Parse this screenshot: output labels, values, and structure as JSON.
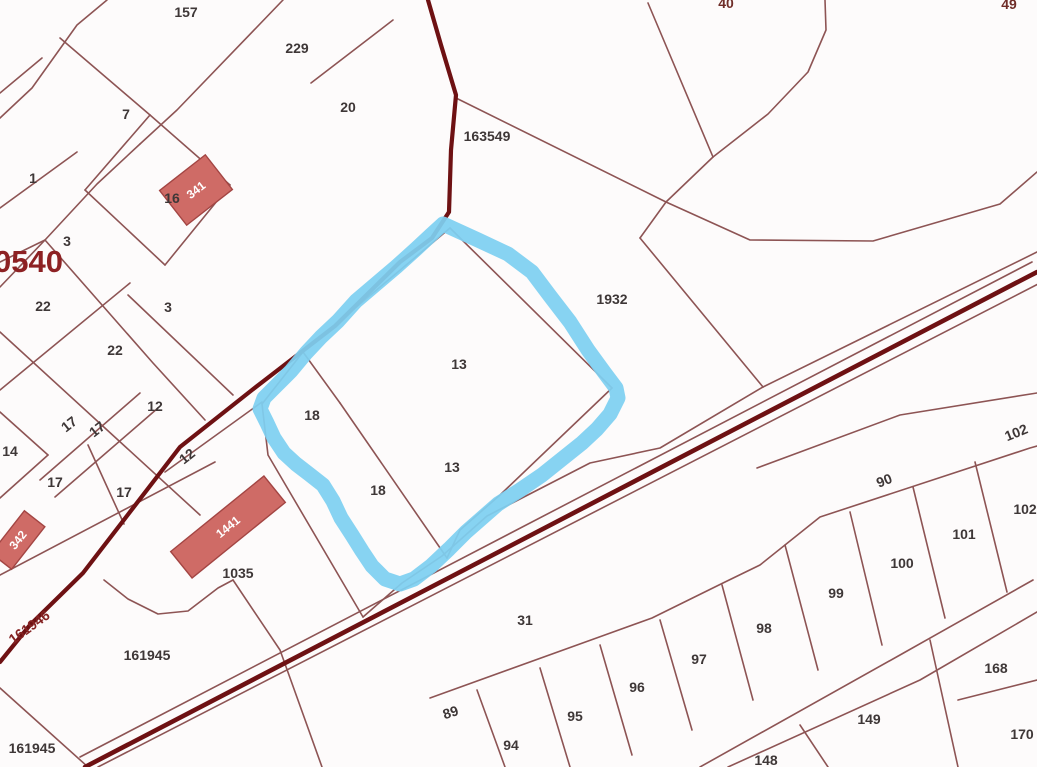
{
  "map": {
    "type": "cadastral-parcel-map",
    "background": "#fdfbfb",
    "colors": {
      "parcel_line": "#8d5454",
      "road_line": "#6e1113",
      "highlight_blue": "#7ed0f1",
      "building_fill": "#cf6b66",
      "building_stroke": "#a34543",
      "label_color": "#3e3737",
      "quarter_label_color": "#8d2123",
      "road_label_color": "#842222",
      "building_label_color": "#ffffff"
    },
    "quarter_label": {
      "text": "0540",
      "x": -6,
      "y": 272,
      "size": 31
    },
    "parcel_labels": [
      {
        "text": "157",
        "x": 186,
        "y": 17
      },
      {
        "text": "229",
        "x": 297,
        "y": 53
      },
      {
        "text": "7",
        "x": 126,
        "y": 119
      },
      {
        "text": "20",
        "x": 348,
        "y": 112
      },
      {
        "text": "163549",
        "x": 487,
        "y": 141
      },
      {
        "text": "1",
        "x": 33,
        "y": 183
      },
      {
        "text": "16",
        "x": 172,
        "y": 203
      },
      {
        "text": "3",
        "x": 67,
        "y": 246
      },
      {
        "text": "22",
        "x": 43,
        "y": 311
      },
      {
        "text": "3",
        "x": 168,
        "y": 312
      },
      {
        "text": "22",
        "x": 115,
        "y": 355
      },
      {
        "text": "12",
        "x": 155,
        "y": 411
      },
      {
        "text": "17",
        "x": 72,
        "y": 428,
        "rot": -38
      },
      {
        "text": "17",
        "x": 100,
        "y": 433,
        "rot": -38
      },
      {
        "text": "14",
        "x": 10,
        "y": 456
      },
      {
        "text": "17",
        "x": 55,
        "y": 487
      },
      {
        "text": "17",
        "x": 124,
        "y": 497
      },
      {
        "text": "12",
        "x": 190,
        "y": 460,
        "rot": -38
      },
      {
        "text": "1932",
        "x": 612,
        "y": 304
      },
      {
        "text": "13",
        "x": 459,
        "y": 369
      },
      {
        "text": "18",
        "x": 312,
        "y": 420
      },
      {
        "text": "13",
        "x": 452,
        "y": 472
      },
      {
        "text": "18",
        "x": 378,
        "y": 495
      },
      {
        "text": "1035",
        "x": 238,
        "y": 578
      },
      {
        "text": "161946",
        "x": 32,
        "y": 631,
        "rot": -36,
        "color": "#842222"
      },
      {
        "text": "161945",
        "x": 147,
        "y": 660
      },
      {
        "text": "161945",
        "x": 32,
        "y": 753
      },
      {
        "text": "31",
        "x": 525,
        "y": 625
      },
      {
        "text": "89",
        "x": 452,
        "y": 717,
        "rot": -18
      },
      {
        "text": "94",
        "x": 511,
        "y": 750
      },
      {
        "text": "95",
        "x": 575,
        "y": 721
      },
      {
        "text": "96",
        "x": 637,
        "y": 692
      },
      {
        "text": "97",
        "x": 699,
        "y": 664
      },
      {
        "text": "98",
        "x": 764,
        "y": 633
      },
      {
        "text": "99",
        "x": 836,
        "y": 598
      },
      {
        "text": "100",
        "x": 902,
        "y": 568
      },
      {
        "text": "101",
        "x": 964,
        "y": 539
      },
      {
        "text": "102",
        "x": 1025,
        "y": 514
      },
      {
        "text": "90",
        "x": 886,
        "y": 485,
        "rot": -22
      },
      {
        "text": "102",
        "x": 1018,
        "y": 437,
        "rot": -22
      },
      {
        "text": "148",
        "x": 766,
        "y": 765
      },
      {
        "text": "149",
        "x": 869,
        "y": 724
      },
      {
        "text": "168",
        "x": 996,
        "y": 673
      },
      {
        "text": "170",
        "x": 1022,
        "y": 739
      },
      {
        "text": "40",
        "x": 726,
        "y": 8,
        "color": "#6f2d28"
      },
      {
        "text": "49",
        "x": 1009,
        "y": 9,
        "color": "#6f2d28"
      }
    ],
    "buildings": [
      {
        "label": "341",
        "cx": 196,
        "cy": 190,
        "w": 58,
        "h": 44,
        "rot": -38
      },
      {
        "label": "1441",
        "cx": 228,
        "cy": 527,
        "w": 120,
        "h": 34,
        "rot": -39
      },
      {
        "label": "342",
        "cx": 18,
        "cy": 540,
        "w": 54,
        "h": 26,
        "rot": -52
      }
    ],
    "roads": [
      {
        "name": "road-north-south",
        "width": 4.2,
        "points": [
          [
            428,
            0
          ],
          [
            441,
            45
          ],
          [
            456,
            95
          ],
          [
            451,
            150
          ],
          [
            449,
            212
          ],
          [
            432,
            238
          ],
          [
            400,
            262
          ],
          [
            335,
            326
          ],
          [
            252,
            390
          ],
          [
            180,
            447
          ],
          [
            83,
            573
          ],
          [
            30,
            625
          ],
          [
            0,
            662
          ]
        ]
      },
      {
        "name": "road-diagonal",
        "width": 4.6,
        "points": [
          [
            85,
            767
          ],
          [
            1037,
            272
          ]
        ]
      }
    ],
    "highlight": {
      "name": "selected-parcel-outline",
      "color": "#7ed0f1",
      "width": 15,
      "opacity": 0.93,
      "points": [
        [
          443,
          224
        ],
        [
          478,
          240
        ],
        [
          508,
          254
        ],
        [
          532,
          272
        ],
        [
          550,
          296
        ],
        [
          570,
          322
        ],
        [
          588,
          350
        ],
        [
          604,
          372
        ],
        [
          616,
          388
        ],
        [
          618,
          398
        ],
        [
          610,
          414
        ],
        [
          597,
          429
        ],
        [
          582,
          443
        ],
        [
          562,
          459
        ],
        [
          542,
          475
        ],
        [
          520,
          490
        ],
        [
          498,
          504
        ],
        [
          482,
          518
        ],
        [
          466,
          532
        ],
        [
          449,
          549
        ],
        [
          431,
          566
        ],
        [
          414,
          579
        ],
        [
          400,
          584
        ],
        [
          385,
          579
        ],
        [
          372,
          566
        ],
        [
          362,
          551
        ],
        [
          352,
          535
        ],
        [
          341,
          518
        ],
        [
          333,
          501
        ],
        [
          323,
          485
        ],
        [
          309,
          474
        ],
        [
          296,
          464
        ],
        [
          284,
          453
        ],
        [
          274,
          438
        ],
        [
          267,
          423
        ],
        [
          260,
          409
        ],
        [
          264,
          398
        ],
        [
          276,
          386
        ],
        [
          291,
          371
        ],
        [
          306,
          353
        ],
        [
          321,
          337
        ],
        [
          338,
          321
        ],
        [
          356,
          301
        ],
        [
          376,
          284
        ],
        [
          396,
          267
        ],
        [
          416,
          249
        ],
        [
          431,
          235
        ],
        [
          443,
          224
        ]
      ]
    },
    "parcel_lines": [
      [
        [
          283,
          0
        ],
        [
          177,
          110
        ],
        [
          140,
          144
        ]
      ],
      [
        [
          107,
          0
        ],
        [
          77,
          25
        ],
        [
          32,
          88
        ],
        [
          0,
          118
        ]
      ],
      [
        [
          60,
          38
        ],
        [
          150,
          115
        ]
      ],
      [
        [
          0,
          93
        ],
        [
          42,
          58
        ]
      ],
      [
        [
          0,
          208
        ],
        [
          77,
          152
        ]
      ],
      [
        [
          0,
          262
        ],
        [
          45,
          240
        ],
        [
          97,
          184
        ],
        [
          140,
          144
        ]
      ],
      [
        [
          0,
          287
        ],
        [
          45,
          240
        ]
      ],
      [
        [
          45,
          240
        ],
        [
          153,
          363
        ],
        [
          205,
          420
        ]
      ],
      [
        [
          150,
          115
        ],
        [
          230,
          185
        ]
      ],
      [
        [
          230,
          185
        ],
        [
          165,
          265
        ]
      ],
      [
        [
          165,
          265
        ],
        [
          85,
          190
        ]
      ],
      [
        [
          85,
          190
        ],
        [
          150,
          115
        ]
      ],
      [
        [
          393,
          20
        ],
        [
          311,
          83
        ]
      ],
      [
        [
          456,
          98
        ],
        [
          666,
          202
        ]
      ],
      [
        [
          648,
          3
        ],
        [
          713,
          157
        ]
      ],
      [
        [
          825,
          0
        ],
        [
          826,
          30
        ],
        [
          808,
          72
        ],
        [
          768,
          114
        ],
        [
          713,
          157
        ]
      ],
      [
        [
          713,
          157
        ],
        [
          666,
          202
        ]
      ],
      [
        [
          666,
          202
        ],
        [
          750,
          240
        ],
        [
          873,
          241
        ],
        [
          1000,
          204
        ],
        [
          1037,
          172
        ]
      ],
      [
        [
          666,
          202
        ],
        [
          640,
          238
        ]
      ],
      [
        [
          640,
          238
        ],
        [
          763,
          387
        ]
      ],
      [
        [
          763,
          387
        ],
        [
          1037,
          252
        ]
      ],
      [
        [
          363,
          617
        ],
        [
          402,
          583
        ],
        [
          442,
          556
        ],
        [
          487,
          516
        ],
        [
          590,
          463
        ],
        [
          660,
          448
        ],
        [
          763,
          387
        ]
      ],
      [
        [
          0,
          390
        ],
        [
          130,
          283
        ]
      ],
      [
        [
          0,
          332
        ],
        [
          200,
          515
        ]
      ],
      [
        [
          128,
          295
        ],
        [
          233,
          395
        ]
      ],
      [
        [
          40,
          480
        ],
        [
          140,
          393
        ]
      ],
      [
        [
          55,
          497
        ],
        [
          158,
          408
        ]
      ],
      [
        [
          0,
          575
        ],
        [
          215,
          462
        ]
      ],
      [
        [
          0,
          412
        ],
        [
          48,
          455
        ]
      ],
      [
        [
          48,
          455
        ],
        [
          0,
          498
        ]
      ],
      [
        [
          88,
          445
        ],
        [
          124,
          524
        ]
      ],
      [
        [
          165,
          472
        ],
        [
          262,
          402
        ]
      ],
      [
        [
          262,
          404
        ],
        [
          268,
          455
        ],
        [
          363,
          617
        ]
      ],
      [
        [
          450,
          228
        ],
        [
          303,
          352
        ]
      ],
      [
        [
          450,
          228
        ],
        [
          612,
          388
        ]
      ],
      [
        [
          612,
          388
        ],
        [
          500,
          495
        ],
        [
          460,
          530
        ],
        [
          447,
          558
        ]
      ],
      [
        [
          303,
          352
        ],
        [
          262,
          404
        ]
      ],
      [
        [
          340,
          403
        ],
        [
          447,
          558
        ]
      ],
      [
        [
          303,
          352
        ],
        [
          340,
          403
        ]
      ],
      [
        [
          104,
          580
        ],
        [
          128,
          599
        ],
        [
          158,
          614
        ],
        [
          188,
          611
        ],
        [
          218,
          588
        ],
        [
          233,
          580
        ]
      ],
      [
        [
          233,
          580
        ],
        [
          280,
          650
        ],
        [
          322,
          767
        ]
      ],
      [
        [
          0,
          688
        ],
        [
          88,
          767
        ]
      ],
      [
        [
          80,
          757
        ],
        [
          1032,
          262
        ]
      ],
      [
        [
          98,
          767
        ],
        [
          1042,
          282
        ]
      ],
      [
        [
          430,
          698
        ],
        [
          652,
          618
        ],
        [
          723,
          583
        ],
        [
          760,
          565
        ],
        [
          820,
          517
        ],
        [
          1030,
          448
        ],
        [
          1037,
          446
        ]
      ],
      [
        [
          757,
          468
        ],
        [
          900,
          415
        ],
        [
          1037,
          393
        ]
      ],
      [
        [
          700,
          767
        ],
        [
          900,
          655
        ],
        [
          1033,
          580
        ]
      ],
      [
        [
          728,
          767
        ],
        [
          920,
          680
        ],
        [
          1037,
          612
        ]
      ],
      [
        [
          477,
          690
        ],
        [
          505,
          767
        ]
      ],
      [
        [
          540,
          668
        ],
        [
          570,
          767
        ]
      ],
      [
        [
          600,
          645
        ],
        [
          632,
          755
        ]
      ],
      [
        [
          660,
          620
        ],
        [
          692,
          730
        ]
      ],
      [
        [
          722,
          585
        ],
        [
          753,
          700
        ]
      ],
      [
        [
          785,
          545
        ],
        [
          818,
          670
        ]
      ],
      [
        [
          850,
          512
        ],
        [
          882,
          645
        ]
      ],
      [
        [
          913,
          487
        ],
        [
          945,
          618
        ]
      ],
      [
        [
          975,
          462
        ],
        [
          1007,
          592
        ]
      ],
      [
        [
          800,
          725
        ],
        [
          828,
          767
        ]
      ],
      [
        [
          930,
          640
        ],
        [
          958,
          767
        ]
      ],
      [
        [
          958,
          700
        ],
        [
          1037,
          680
        ]
      ]
    ]
  }
}
